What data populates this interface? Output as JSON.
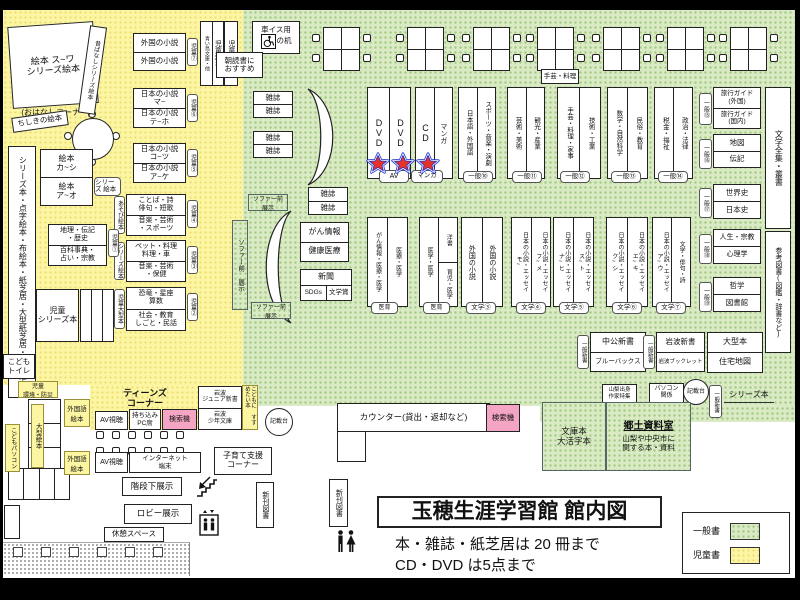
{
  "title": {
    "main": "玉穂生涯学習館 館内図",
    "rule1": "本・雑誌・紙芝居は 20 冊まで",
    "rule2": "CD・DVD は5点まで"
  },
  "legend": {
    "general_label": "一般書",
    "children_label": "児童書"
  },
  "colors": {
    "general_area": "#d9eac4",
    "children_area": "#fcf5a2",
    "search_machine": "#f4a5c4",
    "star_red": "#e63329",
    "star_blue": "#1d2fce"
  },
  "kid": {
    "ohanashi": "絵本 ス~ワ\nシリーズ絵本",
    "ohanashi_caption": "(おはなしコーナー)",
    "mukashibanashi": "昔ばなしシリーズ絵本",
    "chishiki": "ちしきの絵本",
    "foreign": {
      "top": "外国の小説",
      "bottom": "外国の小説",
      "tag": "児童⑦"
    },
    "jp_ma": {
      "top": "日本の小説\nマ~",
      "bottom": "日本の小説\nテ~ホ",
      "tag": "児童⑥"
    },
    "jp_ko": {
      "top": "日本の小説\nコ~ツ",
      "bottom": "日本の小説\nア~ケ",
      "tag": "児童⑤"
    },
    "kotoba": {
      "top": "ことば・詩\n俳句・短歌",
      "bottom": "音楽・芸術\n・スポーツ",
      "tag": "児童④",
      "side": "あそび絵本"
    },
    "pet": {
      "top": "ペット・料理\n料理・車",
      "bottom": "音楽・芸術\n・保健",
      "tag": "児童③",
      "side": "シリーズ絵本"
    },
    "dino": {
      "top": "恐竜・星座\n算数",
      "bottom": "社会・教育\nしごと・民話",
      "tag": "児童②",
      "side": "児童大型本"
    },
    "chiri": {
      "top": "地理・伝記\n・歴史",
      "bottom": "百科事典・\n占い・宗教",
      "tag": "児童①"
    },
    "ehon": {
      "top": "絵本\nカ~シ",
      "bottom": "絵本\nア~オ",
      "side": "シリーズ\n絵本"
    },
    "kamishibai": "シリーズ本・点字絵本・布絵本・紙芝居・大型紙芝居・大型絵本",
    "jido_series": "児童\nシリーズ本",
    "kodomo_toilet": "こども\nトイレ",
    "jido_shinsho": "児童新書",
    "aoitori": "青い鳥文庫・他",
    "jido_bunko": "児童文庫",
    "asadoku": "朝読書に\nおすすめ",
    "kankyo": "児童\n環境・防災",
    "ogata_ehon": "大型絵本",
    "kodomo_pc": "こどもパソコン"
  },
  "gen": {
    "wheel_desk1": "車イス用",
    "wheel_desk2": "の机",
    "zasshi": "雑誌",
    "dvd": "DVD",
    "cd": "CD",
    "manga": "マンガ",
    "tag_av": "AV",
    "tag_manga": "マンガ",
    "craft_note": "手芸・料理",
    "g10": {
      "left": "日本語・外国語",
      "right": "スポーツ・音楽・演劇",
      "tag": "一般⑩"
    },
    "g11": {
      "left": "芸術・美術",
      "right": "観光・産業",
      "tag": "一般⑪"
    },
    "g12": {
      "left": "手芸・料理・家事",
      "right": "技術・工業",
      "tag": "一般⑫"
    },
    "g13": {
      "left": "数学・自然科学",
      "right": "民俗・教育",
      "tag": "一般⑬"
    },
    "g14": {
      "left": "税金・福祉",
      "right": "政治・法律",
      "tag": "一般⑭"
    },
    "g15": {
      "top": "旅行ガイド\n(外国)",
      "bottom": "旅行ガイド\n(国内)",
      "tag": "一般⑮"
    },
    "g16": {
      "top": "地図",
      "bottom": "伝記",
      "tag": "一般⑯"
    },
    "g17": {
      "top": "世界史",
      "bottom": "日本史",
      "tag": "一般⑰"
    },
    "g18": {
      "top": "人生・宗教",
      "bottom": "心理学",
      "tag": "一般⑱"
    },
    "g19": {
      "top": "哲学",
      "bottom": "図書館",
      "tag": "一般⑲"
    },
    "bungaku_zenshu": "文学全集・叢書",
    "sanko": "参考図書(図鑑・辞書など)"
  },
  "mid": {
    "sofa": "ソファー前\n展示",
    "gan": {
      "top": "がん情報",
      "bottom": "健康医療"
    },
    "news": {
      "top": "新聞",
      "bl": "SDGs",
      "br": "文学賞"
    },
    "medA": {
      "left": "がん情報・医療・医学",
      "right": "医療・医学",
      "tag": "医育"
    },
    "medB": {
      "left": "医学・医学",
      "rt": "洋書",
      "rb": "育児・医学",
      "tag": "医育"
    },
    "lit3": {
      "left": "外国の小説",
      "right": "外国の小説",
      "tag": "文学③"
    },
    "lit4": {
      "left": "日本の小説・エッセイ\nモ~",
      "right": "日本の小説・エッセイ\nフ~メ",
      "tag": "文学④"
    },
    "lit5": {
      "left": "日本の小説・エッセイ\nナ~ヒ",
      "right": "日本の小説・エッセイ\nス~ト",
      "tag": "文学⑤"
    },
    "lit6": {
      "left": "日本の小説・エッセイ\nク~シ",
      "right": "日本の小説・エッセイ\nエ~キ",
      "tag": "文学⑥"
    },
    "lit7": {
      "left": "日本の小説・エッセイ\nア~ウ",
      "right": "文学・俳句・詩",
      "tag": "文学⑦"
    }
  },
  "south": {
    "chuko": {
      "top": "中公新書",
      "bottom": "ブルーバックス",
      "tag": "一般新書"
    },
    "iwanami": {
      "top": "岩波新書",
      "bottom": "岩波ブックレット",
      "tag": "一般新書"
    },
    "ogata": {
      "top": "大型本",
      "bottom": "住宅地図"
    },
    "yamanashi": "山梨出身\n作家特集",
    "pasokon": "パソコン\n関係",
    "kisaidai": "記載台",
    "series_tag": "一般新書",
    "series_hon": "シリーズ本",
    "bunkobon": "文庫本\n大活字本",
    "kyodo_title": "郷土資料室",
    "kyodo_desc": "山梨や中央市に\n関する本・資料",
    "counter": "カウンター(貸出・返却など)",
    "kensakuki": "検索機"
  },
  "west": {
    "teens": "ティーンズ\nコーナー",
    "av": "AV視聴",
    "pc_seat": "持ち込み\nPC席",
    "iwanami_jr": "岩波\nジュニア新書",
    "iwanami_shonen": "岩波\n少年文庫",
    "susume": "こどもに\nすすめたい本",
    "gaikokugo": "外国語\n絵本",
    "internet": "インターネット\n端末",
    "kosodate": "子育て支援\nコーナー",
    "kaidan": "階段下展示",
    "lobby": "ロビー展示",
    "kyukei": "休憩スペース",
    "shinkan": "新刊図書"
  }
}
